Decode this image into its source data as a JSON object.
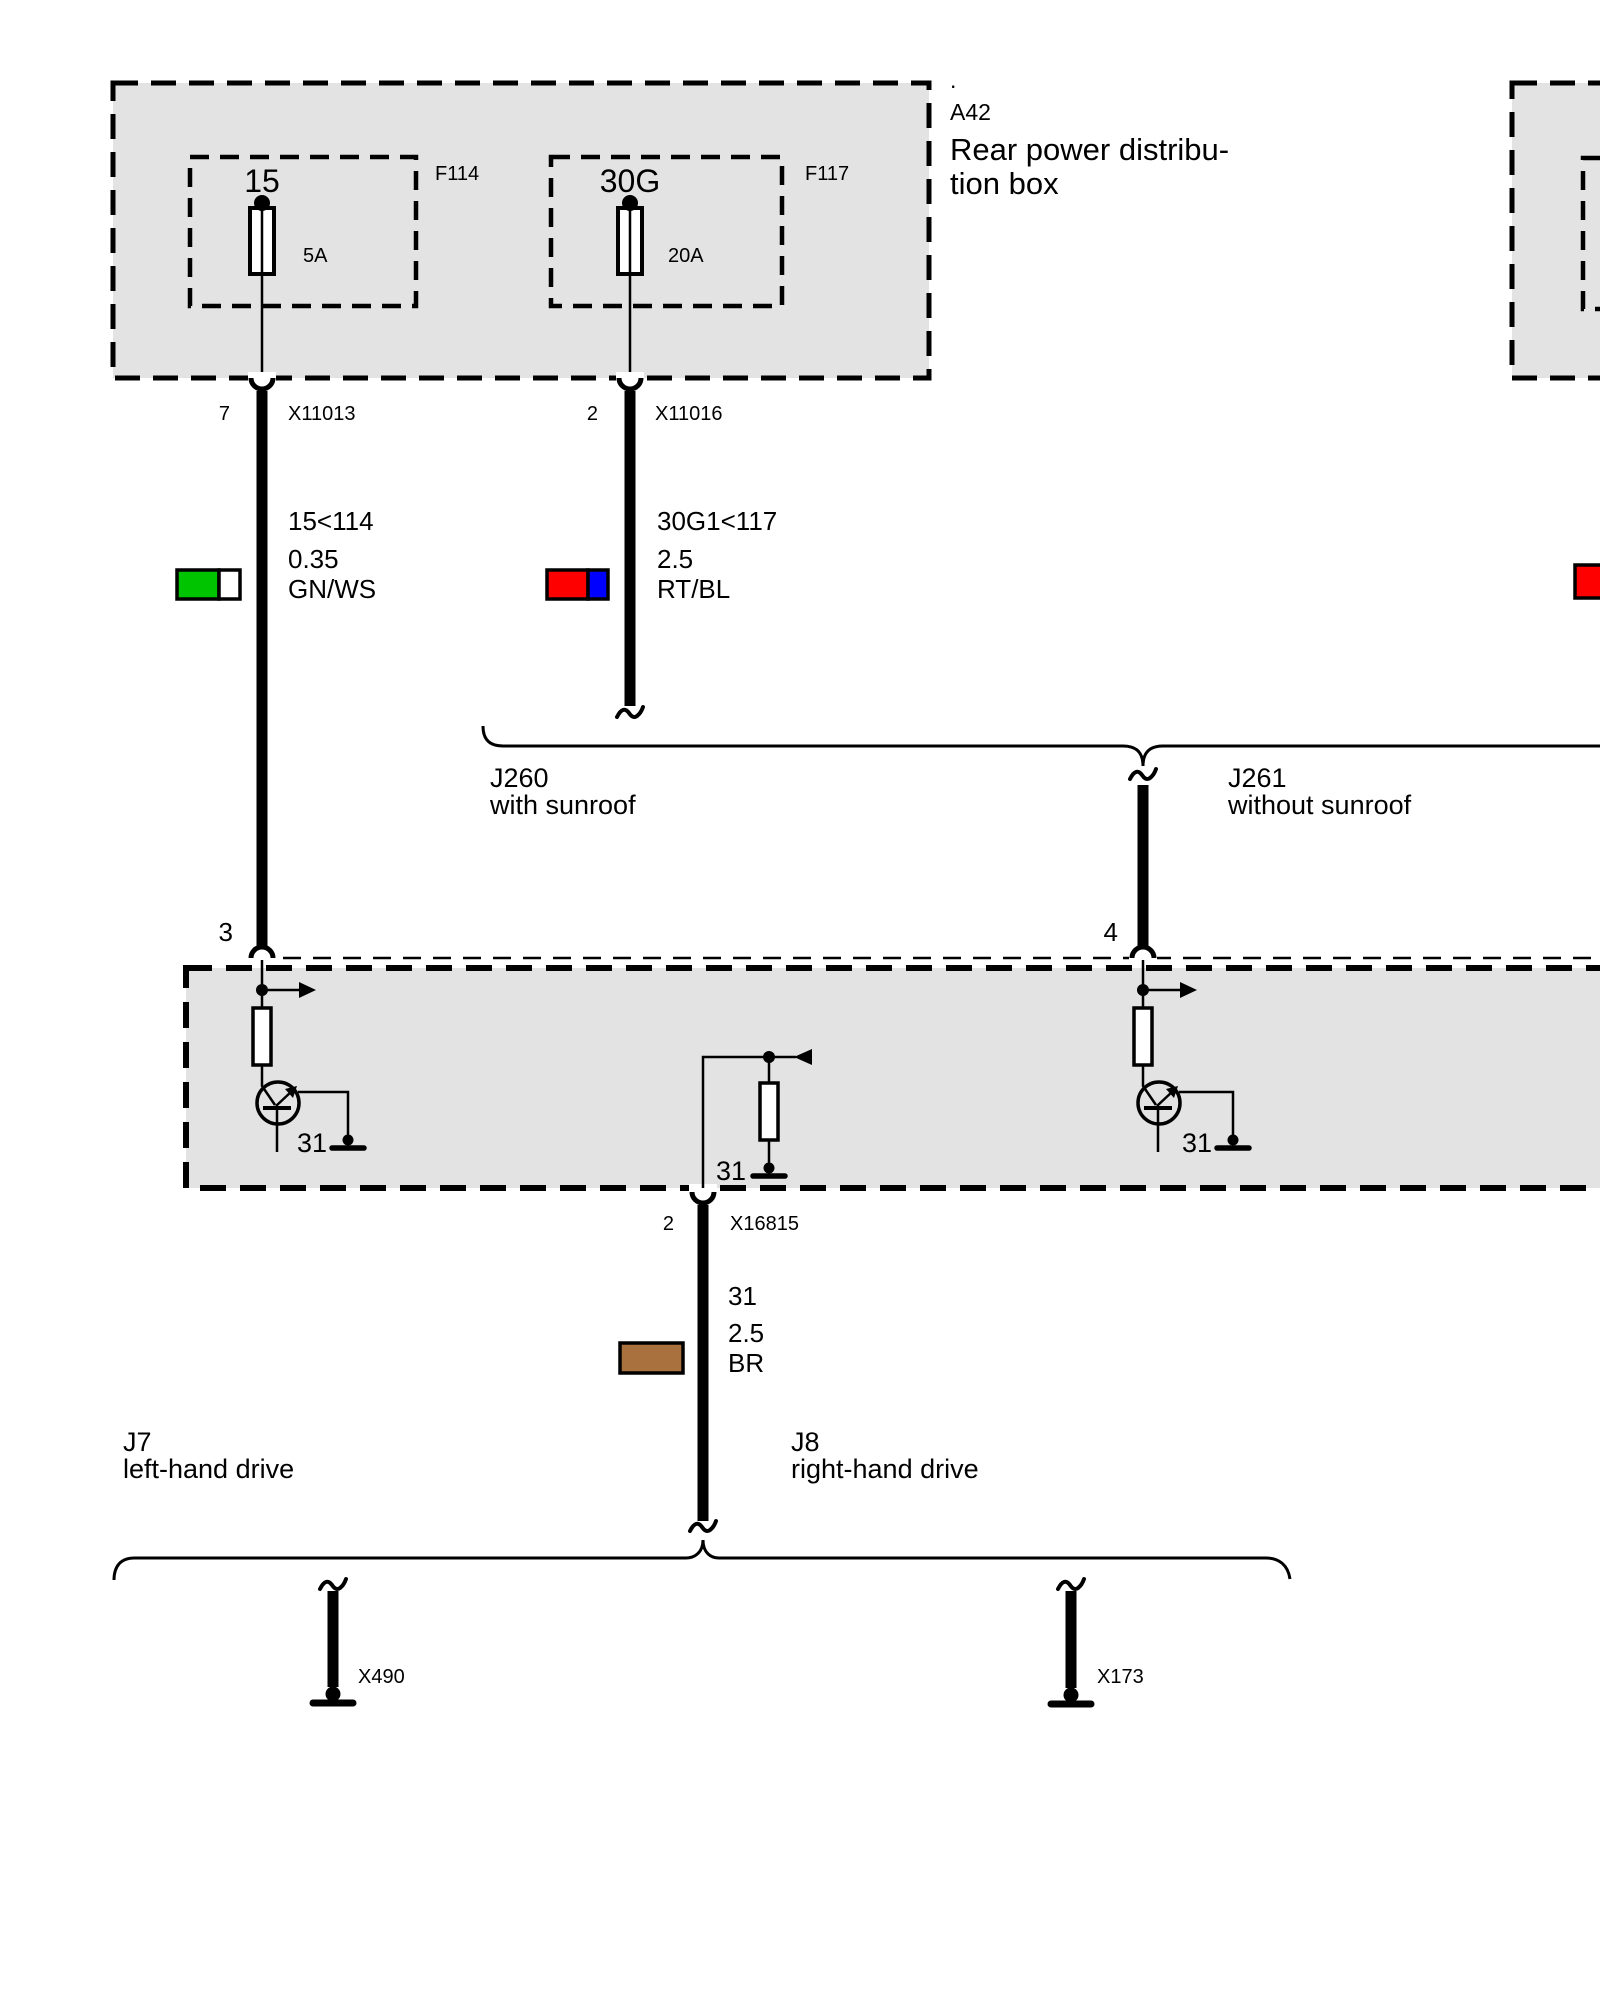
{
  "colors": {
    "box_fill": "#e3e3e3",
    "line": "#000000",
    "green": "#00c400",
    "white": "#ffffff",
    "red": "#ff0000",
    "blue": "#0000ff",
    "brown": "#a9713d"
  },
  "dist_box": {
    "dot": ".",
    "code": "A42",
    "title1": "Rear power distribu-",
    "title2": "tion box",
    "fuse1": {
      "name": "15",
      "rating": "5A",
      "code": "F114"
    },
    "fuse2": {
      "name": "30G",
      "rating": "20A",
      "code": "F117"
    }
  },
  "connectors": {
    "x11013": {
      "pin": "7",
      "code": "X11013"
    },
    "x11016": {
      "pin": "2",
      "code": "X11016"
    },
    "x16815": {
      "pin": "2",
      "code": "X16815"
    }
  },
  "wires": {
    "gnws": {
      "circuit": "15<114",
      "size": "0.35",
      "code": "GN/WS"
    },
    "rtbl": {
      "circuit": "30G1<117",
      "size": "2.5",
      "code": "RT/BL"
    },
    "br": {
      "circuit": "31",
      "size": "2.5",
      "code": "BR"
    }
  },
  "module": {
    "pin3": "3",
    "pin4": "4",
    "gnd_left": "31",
    "gnd_center": "31",
    "gnd_right": "31"
  },
  "options": {
    "j260": {
      "code": "J260",
      "label": "with sunroof"
    },
    "j261": {
      "code": "J261",
      "label": "without sunroof"
    },
    "j7": {
      "code": "J7",
      "label": "left-hand drive"
    },
    "j8": {
      "code": "J8",
      "label": "right-hand drive"
    }
  },
  "grounds": {
    "left": "X490",
    "right": "X173"
  }
}
